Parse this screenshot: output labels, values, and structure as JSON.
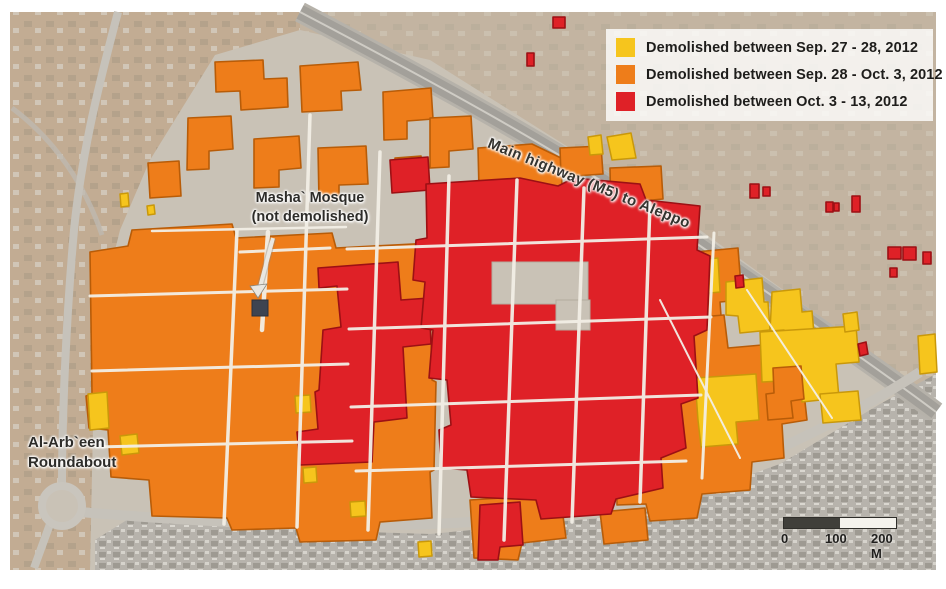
{
  "legend": {
    "items": [
      {
        "label": "Demolished between Sep. 27 - 28, 2012",
        "color": "#F6C51D"
      },
      {
        "label": "Demolished between Sep. 28 - Oct. 3, 2012",
        "color": "#EE7D1A"
      },
      {
        "label": "Demolished between Oct. 3 - 13, 2012",
        "color": "#DF2127"
      }
    ]
  },
  "map_labels": {
    "mosque": {
      "line1": "Masha` Mosque",
      "line2": "(not demolished)"
    },
    "roundabout": {
      "line1": "Al-Arb`een",
      "line2": "Roundabout"
    },
    "highway": "Main highway (M5) to Aleppo"
  },
  "scale_bar": {
    "tick_0": "0",
    "tick_100": "100",
    "tick_200": "200 M"
  },
  "colors": {
    "demolished_sep27_28": "#F6C51D",
    "demolished_sep28_oct3": "#EE7D1A",
    "demolished_oct3_13": "#DF2127",
    "mosque_building": "#3D4451",
    "satellite_base": "#C9C2B6"
  }
}
